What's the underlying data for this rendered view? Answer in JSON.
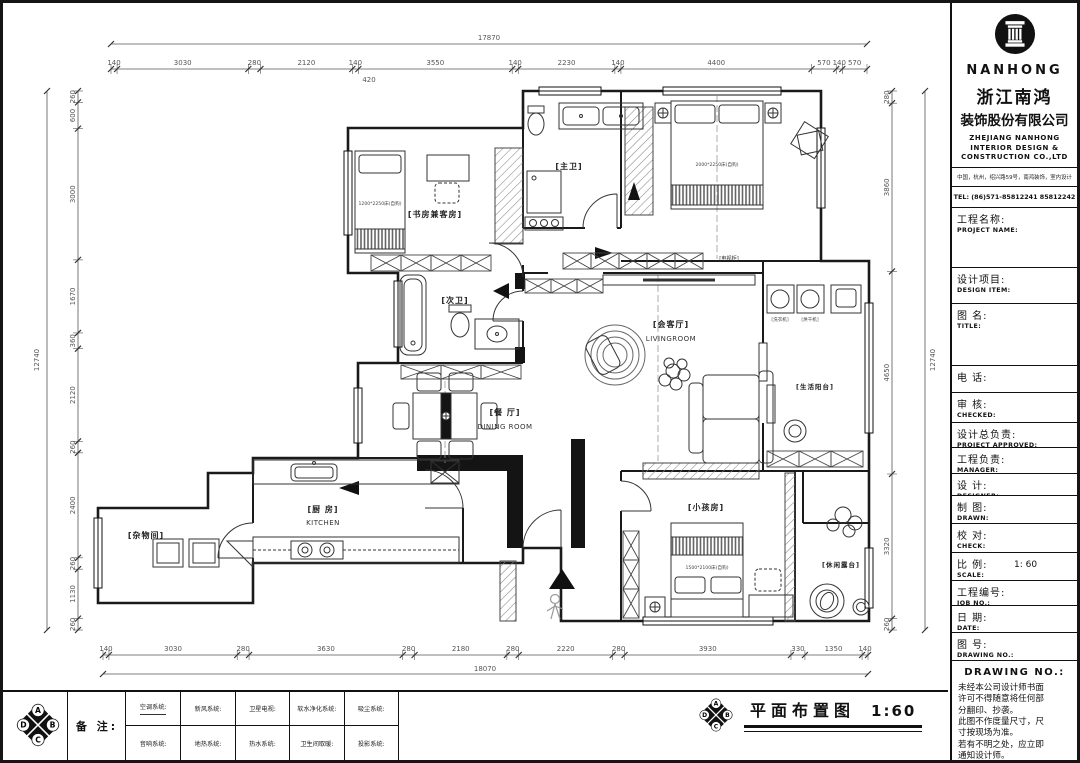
{
  "company": {
    "brand": "NANHONG",
    "name_cn_1": "浙江南鸿",
    "name_cn_2": "装饰股份有限公司",
    "name_en_1": "ZHEJIANG NANHONG",
    "name_en_2": "INTERIOR DESIGN &",
    "name_en_3": "CONSTRUCTION CO.,LTD",
    "address": "中国，杭州，绍兴路59号，南鸿装饰，室内设计",
    "tel": "TEL: (86)571-85812241 85812242"
  },
  "titleblock": {
    "fields": [
      {
        "cn": "工程名称:",
        "en": "PROJECT NAME:",
        "value": ""
      },
      {
        "cn": "设计项目:",
        "en": "DESIGN ITEM:",
        "value": ""
      },
      {
        "cn": "图  名:",
        "en": "TITLE:",
        "value": ""
      },
      {
        "cn": "电    话:",
        "en": "",
        "value": ""
      },
      {
        "cn": "审  核:",
        "en": "CHECKED:",
        "value": ""
      },
      {
        "cn": "设计总负责:",
        "en": "PROJECT APPROVED:",
        "value": ""
      },
      {
        "cn": "工程负责:",
        "en": "MANAGER:",
        "value": ""
      },
      {
        "cn": "设  计:",
        "en": "DESIGNER:",
        "value": ""
      },
      {
        "cn": "制  图:",
        "en": "DRAWN:",
        "value": ""
      },
      {
        "cn": "校  对:",
        "en": "CHECK:",
        "value": ""
      },
      {
        "cn": "比  例:",
        "en": "SCALE:",
        "value": "1: 60"
      },
      {
        "cn": "工程编号:",
        "en": "JOB NO.:",
        "value": ""
      },
      {
        "cn": "日  期:",
        "en": "DATE:",
        "value": ""
      },
      {
        "cn": "图  号:",
        "en": "DRAWING NO.:",
        "value": ""
      }
    ],
    "notes_header": "DRAWING NO.:",
    "notes": [
      "未经本公司设计师书面",
      "许可不得随意将任何部",
      "分翻印、抄袭。",
      "此图不作度量尺寸，尺",
      "寸按现场为准。",
      "若有不明之处，应立即",
      "通知设计师。"
    ]
  },
  "plan": {
    "rooms": {
      "study": "[书房兼客房]",
      "master_bath": "[主卫]",
      "second_bath": "[次卫]",
      "living_cn": "[会客厅]",
      "living_en": "LIVINGROOM",
      "dining_cn": "[餐 厅]",
      "dining_en": "DINING  ROOM",
      "kitchen_cn": "[厨 房]",
      "kitchen_en": "KITCHEN",
      "storage": "[杂物间]",
      "kids": "[小孩房]",
      "service_balcony": "[生活阳台]",
      "leisure_terrace": "[休闲露台]"
    },
    "annotations": {
      "study_bed": "1200*2250床(自购)",
      "master_bed": "2000*2250床(自购)",
      "kids_bed": "1500*2100床(自购)",
      "tv_cabinet": "[电视柜]",
      "washer": "[洗衣机]",
      "dryer": "[烘干机]"
    }
  },
  "dimensions": {
    "top": {
      "values": [
        "140",
        "3030",
        "280",
        "2120",
        "140",
        "3550",
        "140",
        "2230",
        "140",
        "4400",
        "570",
        "140",
        "570"
      ],
      "sub": "420",
      "total": "17870"
    },
    "bottom": {
      "values": [
        "140",
        "3030",
        "280",
        "3630",
        "280",
        "2180",
        "280",
        "2220",
        "280",
        "3930",
        "330",
        "1350",
        "140"
      ],
      "total": "18070"
    },
    "left": {
      "values": [
        "260",
        "600",
        "3000",
        "1670",
        "360",
        "2120",
        "260",
        "2400",
        "260",
        "1130",
        "260"
      ],
      "total": "12740"
    },
    "right": {
      "values": [
        "280",
        "3860",
        "4650",
        "3320",
        "260"
      ],
      "total": "12740"
    }
  },
  "legend": {
    "note_label": "备 注:",
    "rows": [
      [
        "空调系统:",
        "新风系统:",
        "卫星电视:",
        "软水净化系统:",
        "吸尘系统:"
      ],
      [
        "音响系统:",
        "地热系统:",
        "热水系统:",
        "卫生间取暖:",
        "投影系统:"
      ]
    ]
  },
  "sheet_title": {
    "text": "平面布置图",
    "scale": "1:60"
  },
  "compass": {
    "letters": [
      "A",
      "B",
      "C",
      "D"
    ]
  }
}
